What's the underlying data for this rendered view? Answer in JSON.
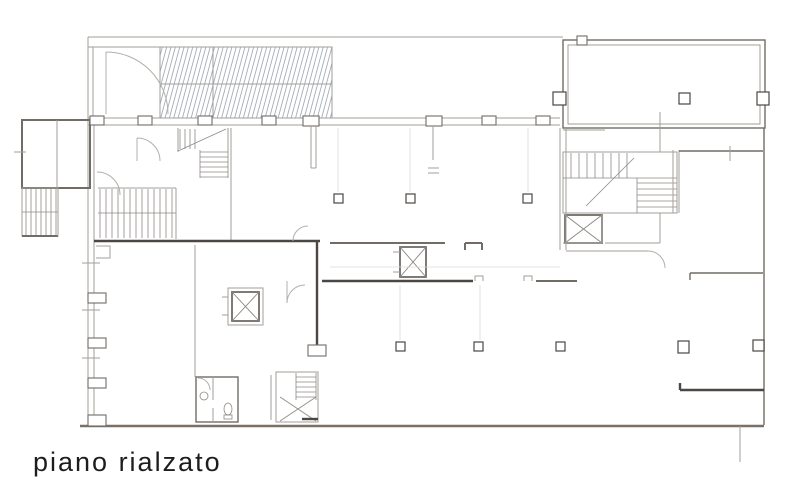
{
  "title": {
    "label": "piano rialzato"
  },
  "drawing": {
    "type": "architectural-floor-plan",
    "floor_label": "piano rialzato",
    "features": [
      "hatched-entrance-ramp",
      "entry-door-swing",
      "annex-room-and-staircase",
      "upper-staircase",
      "main-staircase",
      "core-staircase",
      "service-staircase",
      "elevator-shaft-core",
      "elevator-shaft-central",
      "elevator-shaft-left",
      "bathroom-with-fixtures",
      "structural-column-grid",
      "top-right-room"
    ],
    "colors": {
      "background": "#ffffff",
      "wall_dark": "#4b4742",
      "wall_medium": "#716c66",
      "wall_light": "#a39f9a",
      "bottom_wall": "#7a7066",
      "hatch": "#9aa2ac",
      "door_arc": "#b3b0ab",
      "faint": "#dcdad6",
      "label_text": "#1d1d1b"
    }
  }
}
